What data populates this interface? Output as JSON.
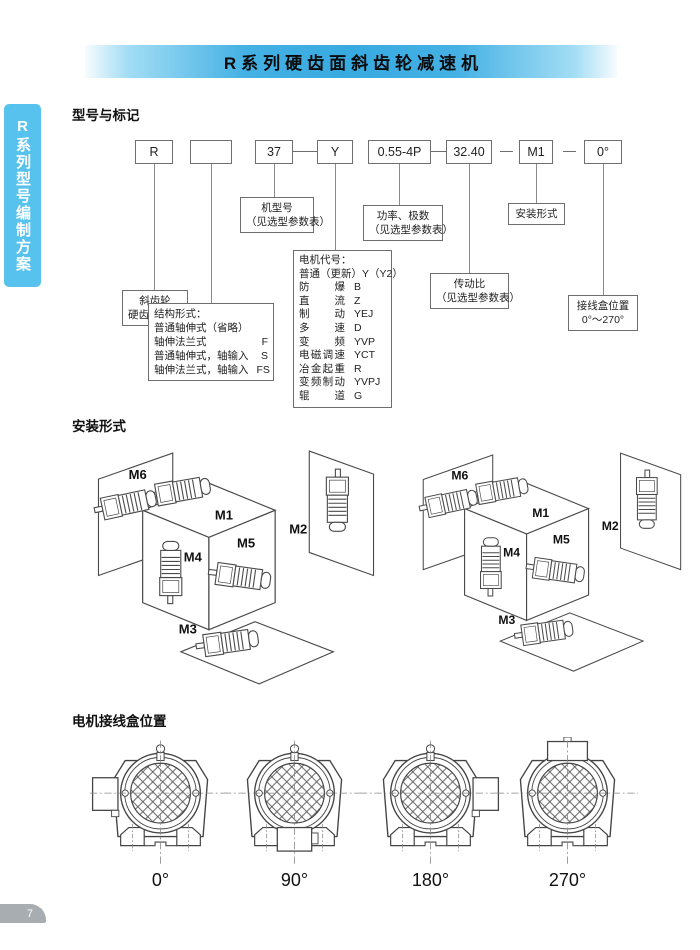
{
  "page": {
    "title": "R系列硬齿面斜齿轮减速机",
    "sidebar_tab": "R系列型号编制方案",
    "page_number": "7",
    "accent_blue": "#37aae0",
    "sidebar_blue": "#58c2ee",
    "tab_gray": "#a8adb2"
  },
  "model_section": {
    "heading": "型号与标记",
    "code_boxes": [
      {
        "text": "R"
      },
      {
        "text": ""
      },
      {
        "text": "37"
      },
      {
        "text": "Y"
      },
      {
        "text": "0.55-4P"
      },
      {
        "text": "32.40"
      },
      {
        "text": "M1"
      },
      {
        "text": "0°"
      }
    ],
    "callouts": {
      "reducer_line1": "斜齿轮",
      "reducer_line2": "硬齿面减速机",
      "structure_title": "结构形式：",
      "structure_rows": [
        {
          "label": "普通轴伸式（省略）",
          "code": ""
        },
        {
          "label": "轴伸法兰式",
          "code": "F"
        },
        {
          "label": "普通轴伸式，轴输入",
          "code": "S"
        },
        {
          "label": "轴伸法兰式，轴输入",
          "code": "FS"
        }
      ],
      "frame_line1": "机型号",
      "frame_line2": "（见选型参数表）",
      "motor_title": "电机代号：",
      "motor_first": "普通（更新）Y（Y2）",
      "motor_rows": [
        {
          "label": "防爆",
          "code": "B"
        },
        {
          "label": "直流",
          "code": "Z"
        },
        {
          "label": "制动",
          "code": "YEJ"
        },
        {
          "label": "多速",
          "code": "D"
        },
        {
          "label": "变频",
          "code": "YVP"
        },
        {
          "label": "电磁调速",
          "code": "YCT"
        },
        {
          "label": "冶金起重",
          "code": "R"
        },
        {
          "label": "变频制动",
          "code": "YVPJ"
        },
        {
          "label": "辊道",
          "code": "G"
        }
      ],
      "power_line1": "功率、极数",
      "power_line2": "（见选型参数表）",
      "ratio_line1": "传动比",
      "ratio_line2": "（见选型参数表）",
      "mounting_label": "安装形式",
      "terminal_line1": "接线盒位置",
      "terminal_line2": "0°～270°"
    }
  },
  "mounting_section": {
    "heading": "安装形式",
    "labels": [
      "M1",
      "M2",
      "M3",
      "M4",
      "M5",
      "M6"
    ]
  },
  "terminal_section": {
    "heading": "电机接线盒位置",
    "figures": [
      {
        "angle": "0°",
        "box_position": "left"
      },
      {
        "angle": "90°",
        "box_position": "bottom"
      },
      {
        "angle": "180°",
        "box_position": "right"
      },
      {
        "angle": "270°",
        "box_position": "top"
      }
    ]
  }
}
